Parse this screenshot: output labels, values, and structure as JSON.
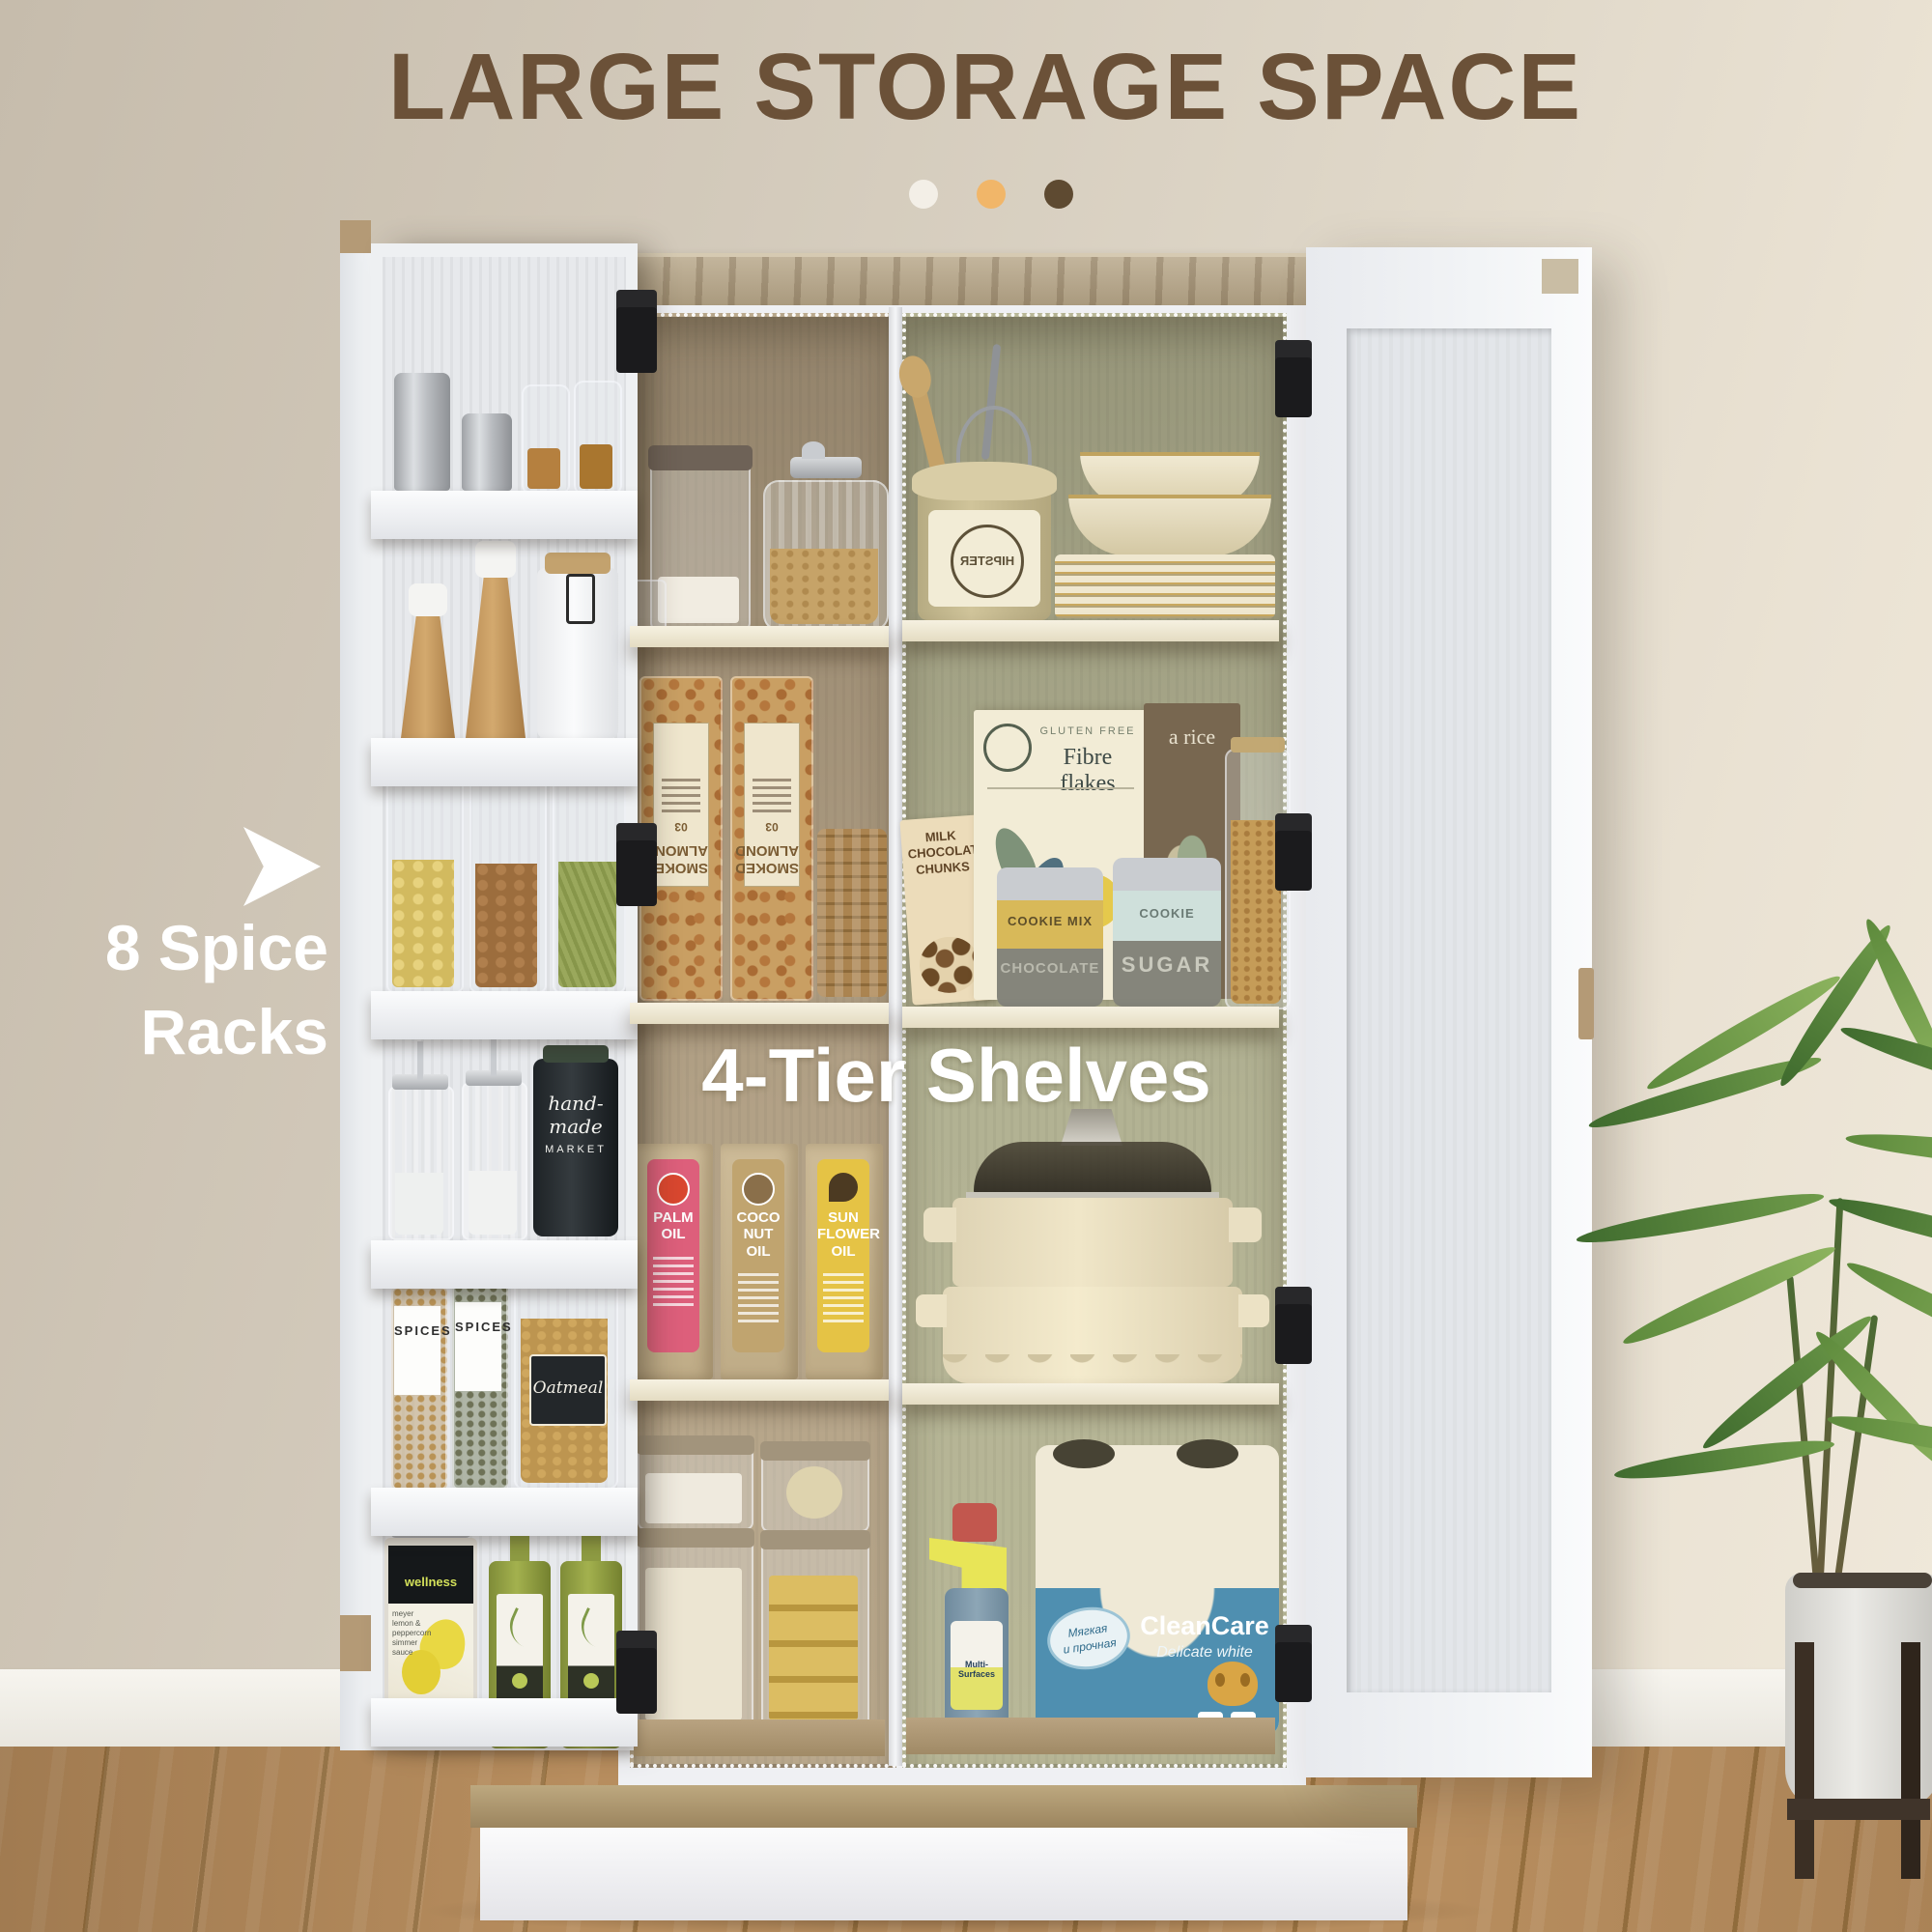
{
  "header": {
    "title": "LARGE STORAGE SPACE",
    "dots": [
      {
        "name": "white-dot",
        "color": "#f3efe7"
      },
      {
        "name": "orange-dot",
        "color": "#f1b669"
      },
      {
        "name": "brown-dot",
        "color": "#5e4a31"
      }
    ]
  },
  "callouts": {
    "spice_racks": {
      "line1": "8 Spice",
      "line2": "Racks"
    },
    "tier_shelves": "4-Tier Shelves"
  },
  "spice_rack": {
    "spices_label": "SPICES",
    "oat_label": "Oatmeal",
    "handmade": {
      "line1": "hand-",
      "line2": "made",
      "line3": "MARKET"
    },
    "wellness_brand": "wellness",
    "wellness_desc": "meyer lemon & peppercorn simmer sauce"
  },
  "middle_cabinet": {
    "almond_label": "SMOKED ALMOND",
    "almond_sub": "03",
    "oils": [
      {
        "name": "PALM OIL",
        "accent": "#dd5f7b",
        "icon": "#d9472f"
      },
      {
        "name": "COCO NUT OIL",
        "accent": "#c0a46f",
        "icon": "#8a6f4a"
      },
      {
        "name": "SUN FLOWER OIL",
        "accent": "#e5c345",
        "icon": "#4c3a22"
      }
    ]
  },
  "right_cabinet": {
    "hipster": "HIPSTER",
    "gluten_free": "GLUTEN FREE",
    "fibre_flakes": "Fibre flakes",
    "rice": "a rice",
    "chocolate": "MILK CHOCOLATE CHUNKS",
    "cookie_mix": "COOKIE MIX",
    "chocolate_band": "CHOCOLATE",
    "cookie2": "COOKIE",
    "sugar": "SUGAR",
    "cleancare_brand": "CleanCare",
    "cleancare_sub": "Delicate white",
    "badge_line1": "Мягкая",
    "badge_line2": "и прочная",
    "spray_label": "Multi-Surfaces",
    "pack4": "4",
    "pack2": "2"
  }
}
